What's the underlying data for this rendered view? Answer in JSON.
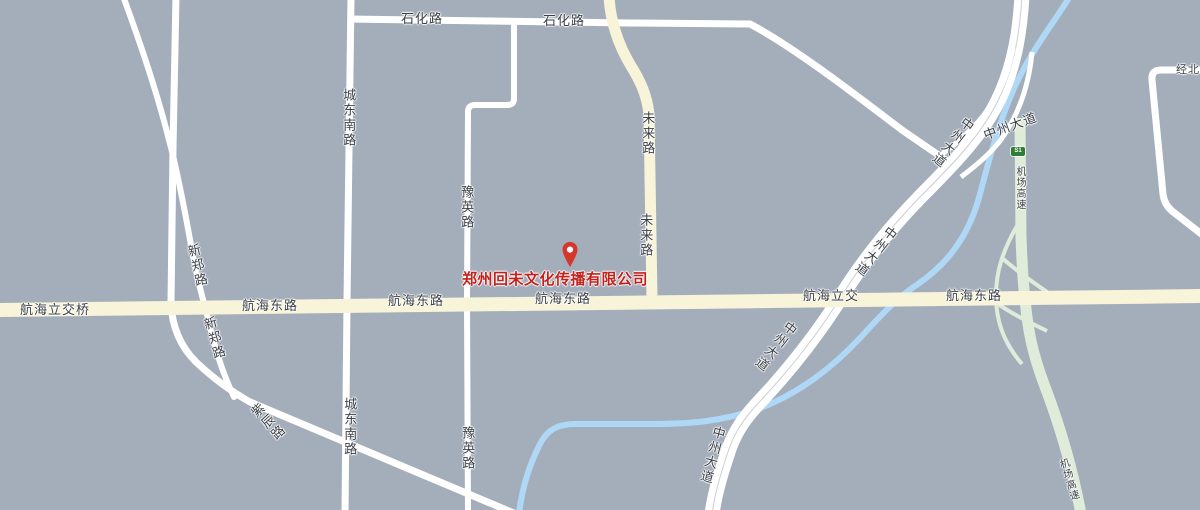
{
  "palette": {
    "background": "#a4aebb",
    "road_white": "#ffffff",
    "road_yellow": "#f8f4d9",
    "road_green": "#dfecd9",
    "river_blue": "#aed8f5",
    "label_dark": "#3c4147",
    "poi_red": "#c5211c",
    "pin_red": "#d6372b",
    "badge_green": "#2f7d33"
  },
  "company": {
    "text": "郑州回未文化传播有限公司"
  },
  "badges": {
    "s1": "S1"
  },
  "labels": [
    {
      "text": "石化路"
    },
    {
      "text": "石化路"
    },
    {
      "text": "城东南路"
    },
    {
      "text": "城东南路"
    },
    {
      "text": "豫英路"
    },
    {
      "text": "豫英路"
    },
    {
      "text": "未来路"
    },
    {
      "text": "未来路"
    },
    {
      "text": "新郑路"
    },
    {
      "text": "新郑路"
    },
    {
      "text": "紫辰路"
    },
    {
      "text": "航海立交桥"
    },
    {
      "text": "航海东路"
    },
    {
      "text": "航海东路"
    },
    {
      "text": "航海东路"
    },
    {
      "text": "航海立交"
    },
    {
      "text": "航海东路"
    },
    {
      "text": "中州大道"
    },
    {
      "text": "中州大道"
    },
    {
      "text": "中州大道"
    },
    {
      "text": "中州大道"
    },
    {
      "text": "中州大道"
    },
    {
      "text": "机场高速"
    },
    {
      "text": "机场高速"
    },
    {
      "text": "经北"
    }
  ]
}
